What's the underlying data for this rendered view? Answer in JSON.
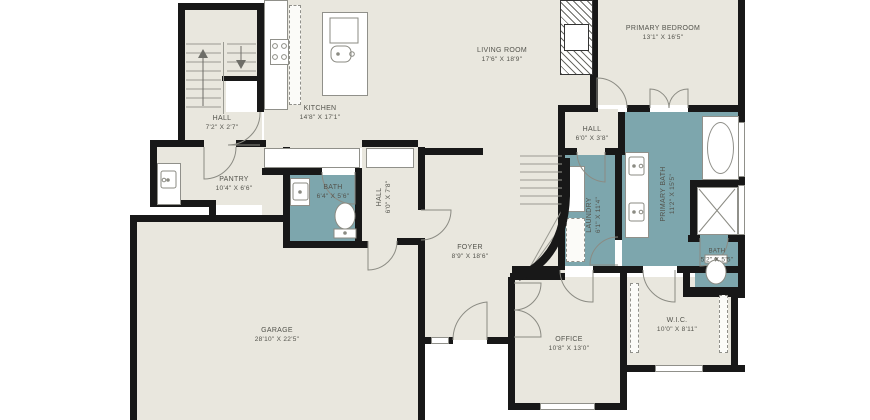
{
  "colors": {
    "bg": "#ffffff",
    "floor": "#e9e7de",
    "wet": "#7da6ad",
    "wall": "#181818",
    "line": "#90908a",
    "text": "#53534c"
  },
  "rooms": [
    {
      "id": "living-room",
      "name": "LIVING ROOM",
      "dims": "17'6\" X 18'9\""
    },
    {
      "id": "primary-bedroom",
      "name": "PRIMARY BEDROOM",
      "dims": "13'1\" X 16'5\""
    },
    {
      "id": "kitchen",
      "name": "KITCHEN",
      "dims": "14'8\" X 17'1\""
    },
    {
      "id": "hall-stairs",
      "name": "HALL",
      "dims": "7'2\" X 2'7\""
    },
    {
      "id": "pantry",
      "name": "PANTRY",
      "dims": "10'4\" X 6'6\""
    },
    {
      "id": "bath",
      "name": "BATH",
      "dims": "6'4\" X 5'6\""
    },
    {
      "id": "hall-mud",
      "name": "HALL",
      "dims": "6'0\" X 7'8\""
    },
    {
      "id": "hall-primary",
      "name": "HALL",
      "dims": "6'0\" X 3'8\""
    },
    {
      "id": "laundry",
      "name": "LAUNDRY",
      "dims": "6'1\" X 11'4\""
    },
    {
      "id": "primary-bath",
      "name": "PRIMARY BATH",
      "dims": "11'2\" X 15'5\""
    },
    {
      "id": "foyer",
      "name": "FOYER",
      "dims": "8'9\" X 18'6\""
    },
    {
      "id": "bath-small",
      "name": "BATH",
      "dims": "5'2\" X 5'5\""
    },
    {
      "id": "office",
      "name": "OFFICE",
      "dims": "10'8\" X 13'0\""
    },
    {
      "id": "wic",
      "name": "W.I.C.",
      "dims": "10'0\" X 8'11\""
    },
    {
      "id": "garage",
      "name": "GARAGE",
      "dims": "28'10\" X 22'5\""
    }
  ]
}
